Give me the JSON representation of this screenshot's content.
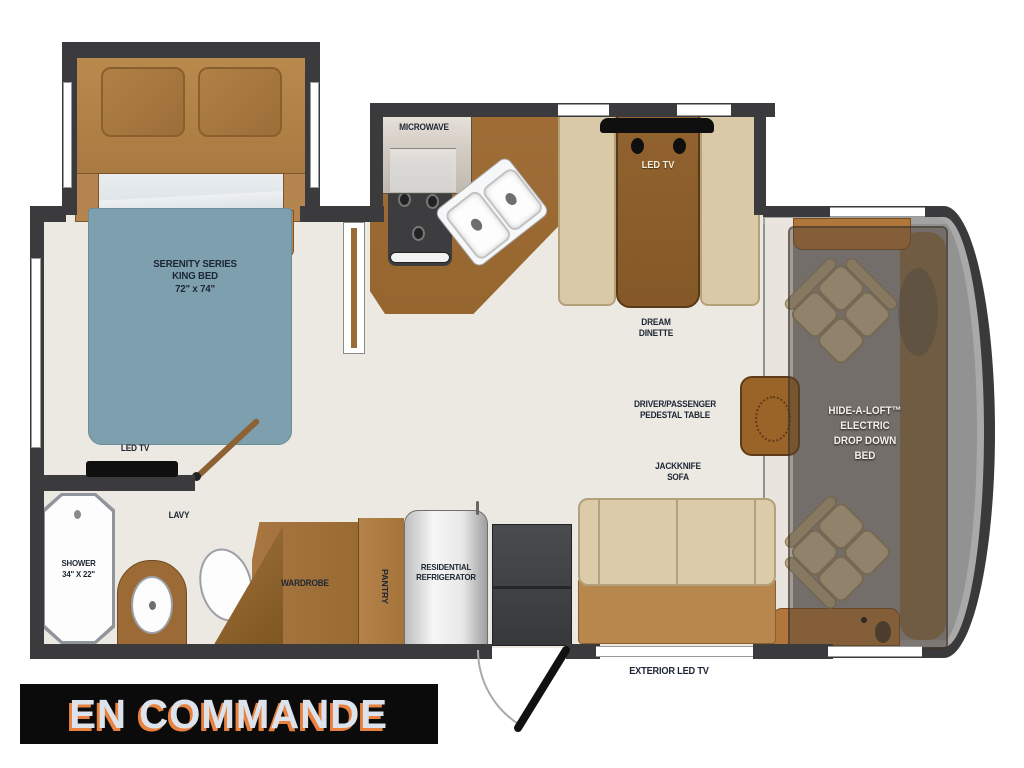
{
  "labels": {
    "bedroom": {
      "line1": "SERENITY SERIES",
      "line2": "KING BED",
      "line3": "72\" x 74\""
    },
    "bedroom_tv": "LED TV",
    "microwave": "MICROWAVE",
    "dinette_tv": "LED TV",
    "dinette": {
      "line1": "DREAM",
      "line2": "DINETTE"
    },
    "pedestal": {
      "line1": "DRIVER/PASSENGER",
      "line2": "PEDESTAL TABLE"
    },
    "sofa": {
      "line1": "JACKKNIFE",
      "line2": "SOFA"
    },
    "loft": {
      "line1": "HIDE-A-LOFT™",
      "line2": "ELECTRIC",
      "line3": "DROP DOWN",
      "line4": "BED"
    },
    "shower": {
      "line1": "SHOWER",
      "line2": "34\" X 22\""
    },
    "lavy": "LAVY",
    "wardrobe": "WARDROBE",
    "pantry": "PANTRY",
    "fridge": {
      "line1": "RESIDENTIAL",
      "line2": "REFRIGERATOR"
    },
    "exterior_tv": "EXTERIOR LED TV",
    "banner": "EN COMMANDE"
  },
  "colors": {
    "wall": "#3b3b3d",
    "floor": "#ece8e2",
    "wood": "#9c6a35",
    "wood_light": "#b5854f",
    "bed_blue": "#7d9fae",
    "bench_beige": "#d9c9a6",
    "sofa_seat": "#b8874d",
    "cab_gray": "#929292",
    "banner_bg": "#0b0b0b",
    "banner_text": "#dde3ec",
    "banner_shadow": "#e8823e",
    "label_text": "#1d2634"
  }
}
